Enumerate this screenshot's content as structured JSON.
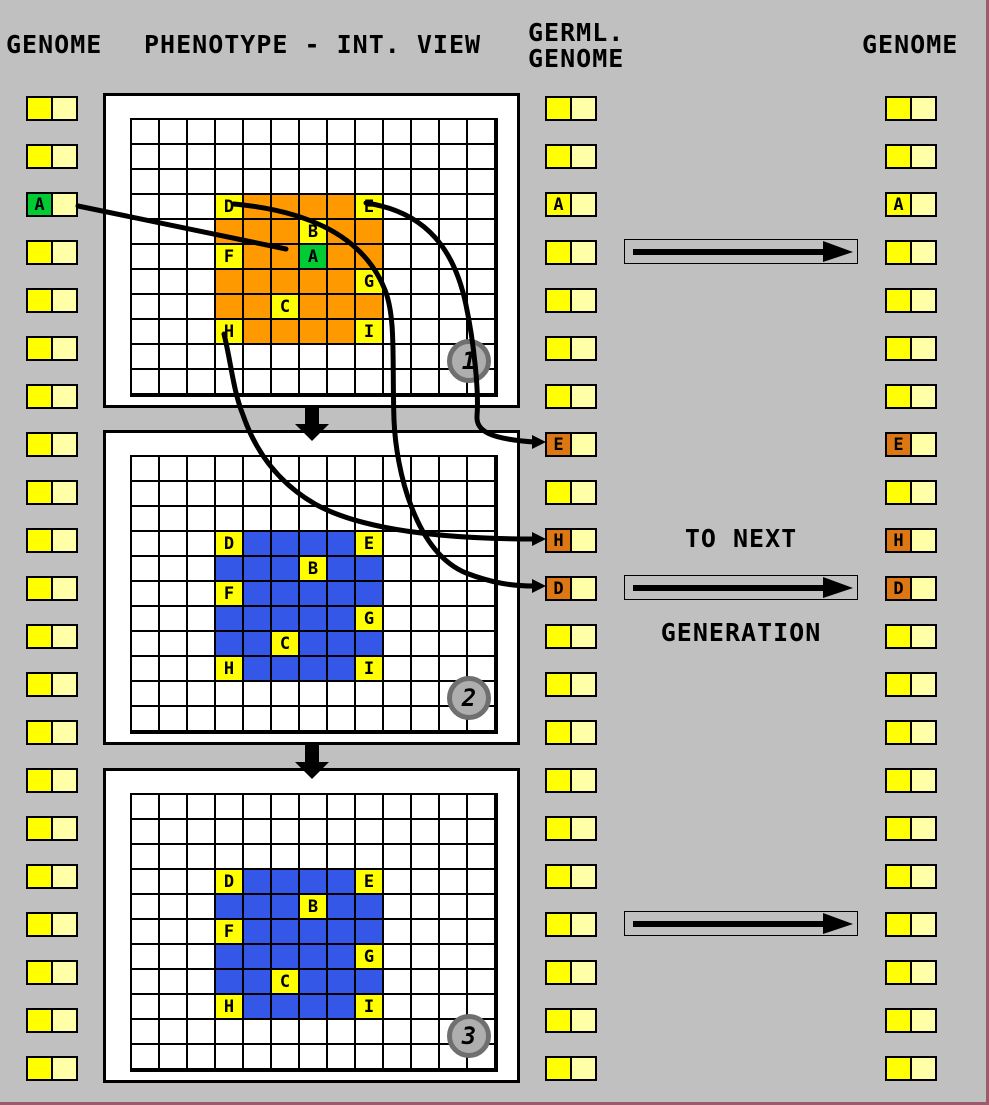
{
  "title_row": {
    "genome_left": "GENOME",
    "phenotype": "PHENOTYPE - INT. VIEW",
    "germline_line1": "GERML.",
    "germline_line2": "GENOME",
    "genome_right": "GENOME"
  },
  "transition": {
    "line1": "TO NEXT",
    "line2": "GENERATION"
  },
  "colors": {
    "background": "#C0C0C0",
    "window_border": "#9C5B6B",
    "yellow": "#FFFF00",
    "pale_yellow": "#FFFFA8",
    "green": "#00CB33",
    "orange": "#FF9900",
    "dark_orange": "#DC7713",
    "blue": "#3557E8",
    "panel_bg": "#FFFFFF",
    "grid_line": "#000000",
    "circle_ring": "#6F6F6F",
    "circle_fill": "#AEAEAE"
  },
  "genome_columns": {
    "row_count": 21,
    "left": {
      "special_cells": [
        {
          "row": 2,
          "letter": "A",
          "color_key": "green"
        }
      ]
    },
    "germline": {
      "special_cells": [
        {
          "row": 2,
          "letter": "A",
          "color_key": "yellow"
        },
        {
          "row": 7,
          "letter": "E",
          "color_key": "dark_orange"
        },
        {
          "row": 9,
          "letter": "H",
          "color_key": "dark_orange"
        },
        {
          "row": 10,
          "letter": "D",
          "color_key": "dark_orange"
        }
      ]
    },
    "right": {
      "special_cells": [
        {
          "row": 2,
          "letter": "A",
          "color_key": "yellow"
        },
        {
          "row": 7,
          "letter": "E",
          "color_key": "dark_orange"
        },
        {
          "row": 9,
          "letter": "H",
          "color_key": "dark_orange"
        },
        {
          "row": 10,
          "letter": "D",
          "color_key": "dark_orange"
        }
      ]
    }
  },
  "phenotype_grid": {
    "rows": 11,
    "cols": 13,
    "block": {
      "row_start": 3,
      "col_start": 3,
      "rows": 6,
      "cols": 6
    }
  },
  "panels": [
    {
      "number": "1",
      "fill_key": "orange",
      "letter_cells": [
        {
          "row": 3,
          "col": 3,
          "letter": "D",
          "color_key": "yellow"
        },
        {
          "row": 3,
          "col": 8,
          "letter": "E",
          "color_key": "yellow"
        },
        {
          "row": 4,
          "col": 6,
          "letter": "B",
          "color_key": "yellow"
        },
        {
          "row": 5,
          "col": 3,
          "letter": "F",
          "color_key": "yellow"
        },
        {
          "row": 5,
          "col": 6,
          "letter": "A",
          "color_key": "green"
        },
        {
          "row": 6,
          "col": 8,
          "letter": "G",
          "color_key": "yellow"
        },
        {
          "row": 7,
          "col": 5,
          "letter": "C",
          "color_key": "yellow"
        },
        {
          "row": 8,
          "col": 3,
          "letter": "H",
          "color_key": "yellow"
        },
        {
          "row": 8,
          "col": 8,
          "letter": "I",
          "color_key": "yellow"
        }
      ]
    },
    {
      "number": "2",
      "fill_key": "blue",
      "letter_cells": [
        {
          "row": 3,
          "col": 3,
          "letter": "D",
          "color_key": "yellow"
        },
        {
          "row": 3,
          "col": 8,
          "letter": "E",
          "color_key": "yellow"
        },
        {
          "row": 4,
          "col": 6,
          "letter": "B",
          "color_key": "yellow"
        },
        {
          "row": 5,
          "col": 3,
          "letter": "F",
          "color_key": "yellow"
        },
        {
          "row": 6,
          "col": 8,
          "letter": "G",
          "color_key": "yellow"
        },
        {
          "row": 7,
          "col": 5,
          "letter": "C",
          "color_key": "yellow"
        },
        {
          "row": 8,
          "col": 3,
          "letter": "H",
          "color_key": "yellow"
        },
        {
          "row": 8,
          "col": 8,
          "letter": "I",
          "color_key": "yellow"
        }
      ]
    },
    {
      "number": "3",
      "fill_key": "blue",
      "letter_cells": [
        {
          "row": 3,
          "col": 3,
          "letter": "D",
          "color_key": "yellow"
        },
        {
          "row": 3,
          "col": 8,
          "letter": "E",
          "color_key": "yellow"
        },
        {
          "row": 4,
          "col": 6,
          "letter": "B",
          "color_key": "yellow"
        },
        {
          "row": 5,
          "col": 3,
          "letter": "F",
          "color_key": "yellow"
        },
        {
          "row": 6,
          "col": 8,
          "letter": "G",
          "color_key": "yellow"
        },
        {
          "row": 7,
          "col": 5,
          "letter": "C",
          "color_key": "yellow"
        },
        {
          "row": 8,
          "col": 3,
          "letter": "H",
          "color_key": "yellow"
        },
        {
          "row": 8,
          "col": 8,
          "letter": "I",
          "color_key": "yellow"
        }
      ]
    }
  ]
}
